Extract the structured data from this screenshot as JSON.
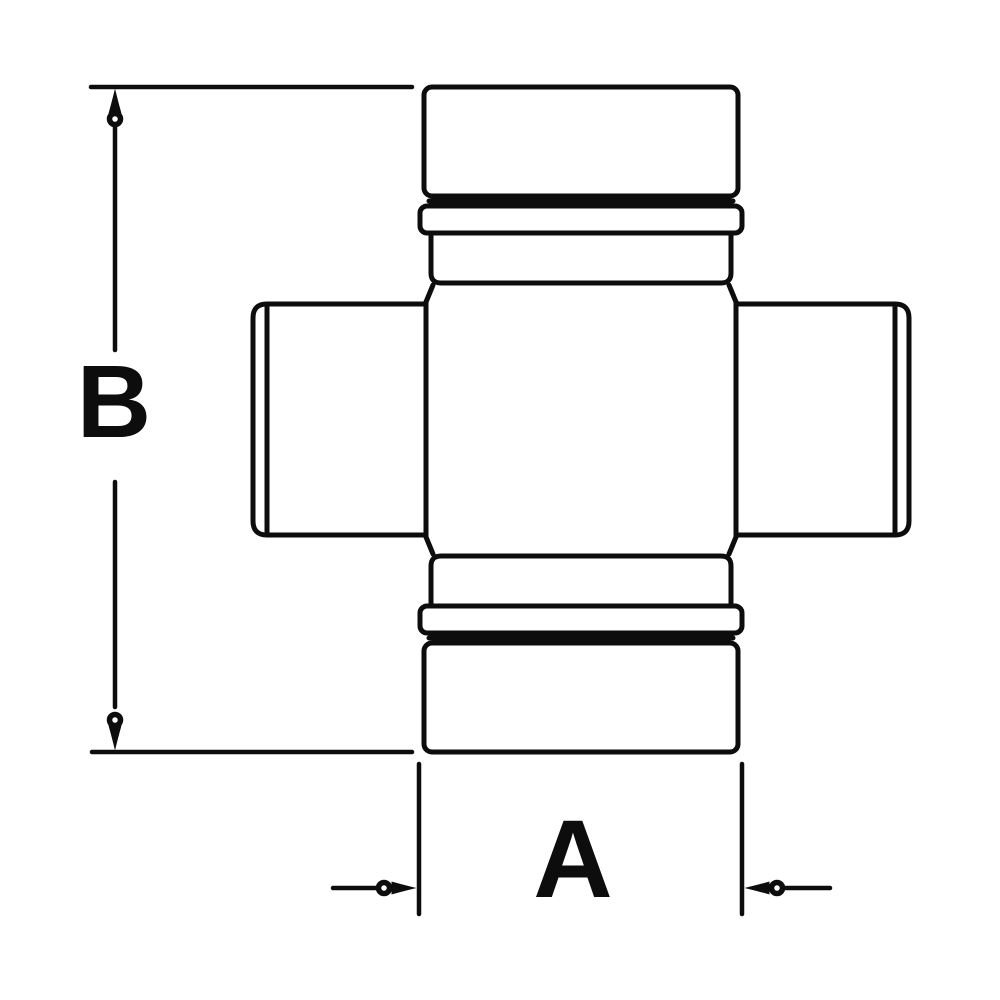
{
  "labels": {
    "dim_vertical": "B",
    "dim_horizontal": "A"
  },
  "colors": {
    "line": "#0d0d0d",
    "background": "#ffffff"
  },
  "icons": {
    "arrow_up": "open-circle-arrow-up",
    "arrow_down": "open-circle-arrow-down",
    "arrow_left": "open-circle-arrow-left",
    "arrow_right": "open-circle-arrow-right"
  }
}
